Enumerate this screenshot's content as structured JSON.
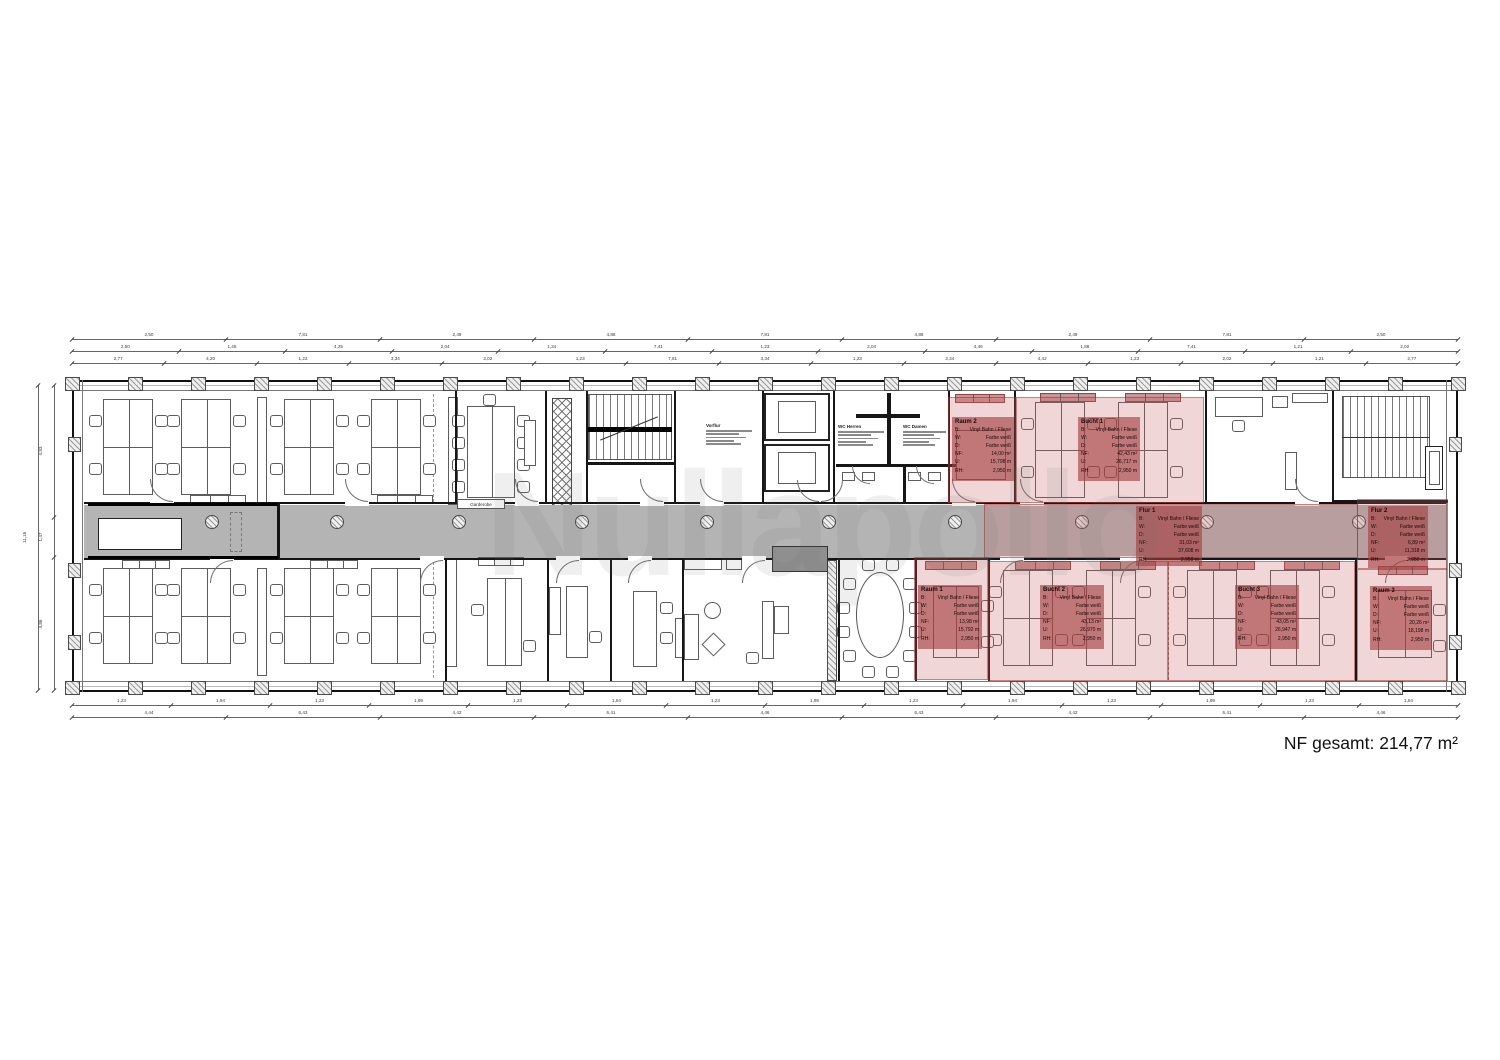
{
  "watermark": "Nullapollo",
  "summary": {
    "nf_total_label": "NF gesamt: 214,77 m²"
  },
  "legend_keys": {
    "b": "B:",
    "w": "W:",
    "d": "D:",
    "nf": "NF:",
    "u": "U:",
    "rh": "RH:"
  },
  "zones": [
    {
      "id": "raum2",
      "name": "Raum 2",
      "floor": "Vinyl Bahn / Fliese",
      "walls": "Farbe weiß",
      "ceiling": "Farbe weiß",
      "nf": "14,00 m²",
      "u": "15,798 m",
      "rh": "2,950 m"
    },
    {
      "id": "bucht1",
      "name": "Bucht 1",
      "floor": "Vinyl Bahn / Fliese",
      "walls": "Farbe weiß",
      "ceiling": "Farbe weiß",
      "nf": "42,43 m²",
      "u": "26,717 m",
      "rh": "2,950 m"
    },
    {
      "id": "flur1",
      "name": "Flur 1",
      "floor": "Vinyl Bahn / Fliese",
      "walls": "Farbe weiß",
      "ceiling": "Farbe weiß",
      "nf": "31,03 m²",
      "u": "37,608 m",
      "rh": "2,950 m"
    },
    {
      "id": "flur2",
      "name": "Flur 2",
      "floor": "Vinyl Bahn / Fliese",
      "walls": "Farbe weiß",
      "ceiling": "Farbe weiß",
      "nf": "6,89 m²",
      "u": "11,318 m",
      "rh": "2,950 m"
    },
    {
      "id": "raum1",
      "name": "Raum 1",
      "floor": "Vinyl Bahn / Fliese",
      "walls": "Farbe weiß",
      "ceiling": "Farbe weiß",
      "nf": "13,98 m²",
      "u": "15,792 m",
      "rh": "2,950 m"
    },
    {
      "id": "bucht2",
      "name": "Bucht 2",
      "floor": "Vinyl Bahn / Fliese",
      "walls": "Farbe weiß",
      "ceiling": "Farbe weiß",
      "nf": "43,13 m²",
      "u": "26,970 m",
      "rh": "2,950 m"
    },
    {
      "id": "bucht3",
      "name": "Bucht 3",
      "floor": "Vinyl Bahn / Fliese",
      "walls": "Farbe weiß",
      "ceiling": "Farbe weiß",
      "nf": "43,05 m²",
      "u": "26,947 m",
      "rh": "2,950 m"
    },
    {
      "id": "raum3",
      "name": "Raum 3",
      "floor": "Vinyl Bahn / Fliese",
      "walls": "Farbe weiß",
      "ceiling": "Farbe weiß",
      "nf": "20,26 m²",
      "u": "18,198 m",
      "rh": "2,950 m"
    }
  ],
  "room_labels": {
    "garderobe": "Garderobe",
    "vorflur": "Vorflur",
    "wc_herren": "WC Herren",
    "wc_damen": "WC Damen"
  },
  "dimensions": {
    "top_rows": [
      [
        "2,50",
        "7,81",
        "2,49",
        "4,88",
        "7,81",
        "4,88",
        "2,49",
        "7,81",
        "2,50"
      ],
      [
        "2,50",
        "1,46",
        "4,25",
        "2,04",
        "1,34",
        "7,41",
        "1,23",
        "2,04",
        "4,46",
        "1,88",
        "7,41",
        "1,21",
        "2,02"
      ],
      [
        "2,77",
        "4,20",
        "1,23",
        "3,34",
        "2,02",
        "1,23",
        "7,81",
        "3,34",
        "1,23",
        "2,34",
        "4,42",
        "1,23",
        "2,02",
        "1,21",
        "2,77"
      ]
    ],
    "bottom_rows": [
      [
        "1,23",
        "1,94",
        "1,23",
        "1,99",
        "1,23",
        "1,94",
        "1,23",
        "1,99",
        "1,23",
        "1,94",
        "1,23",
        "1,99",
        "1,23",
        "1,94"
      ],
      [
        "4,44",
        "6,43",
        "4,42",
        "6,41",
        "4,46",
        "6,43",
        "4,42",
        "6,41",
        "4,46"
      ]
    ],
    "left_segments": [
      "4,83",
      "1,47",
      "4,86"
    ],
    "left_total": "11,16"
  }
}
